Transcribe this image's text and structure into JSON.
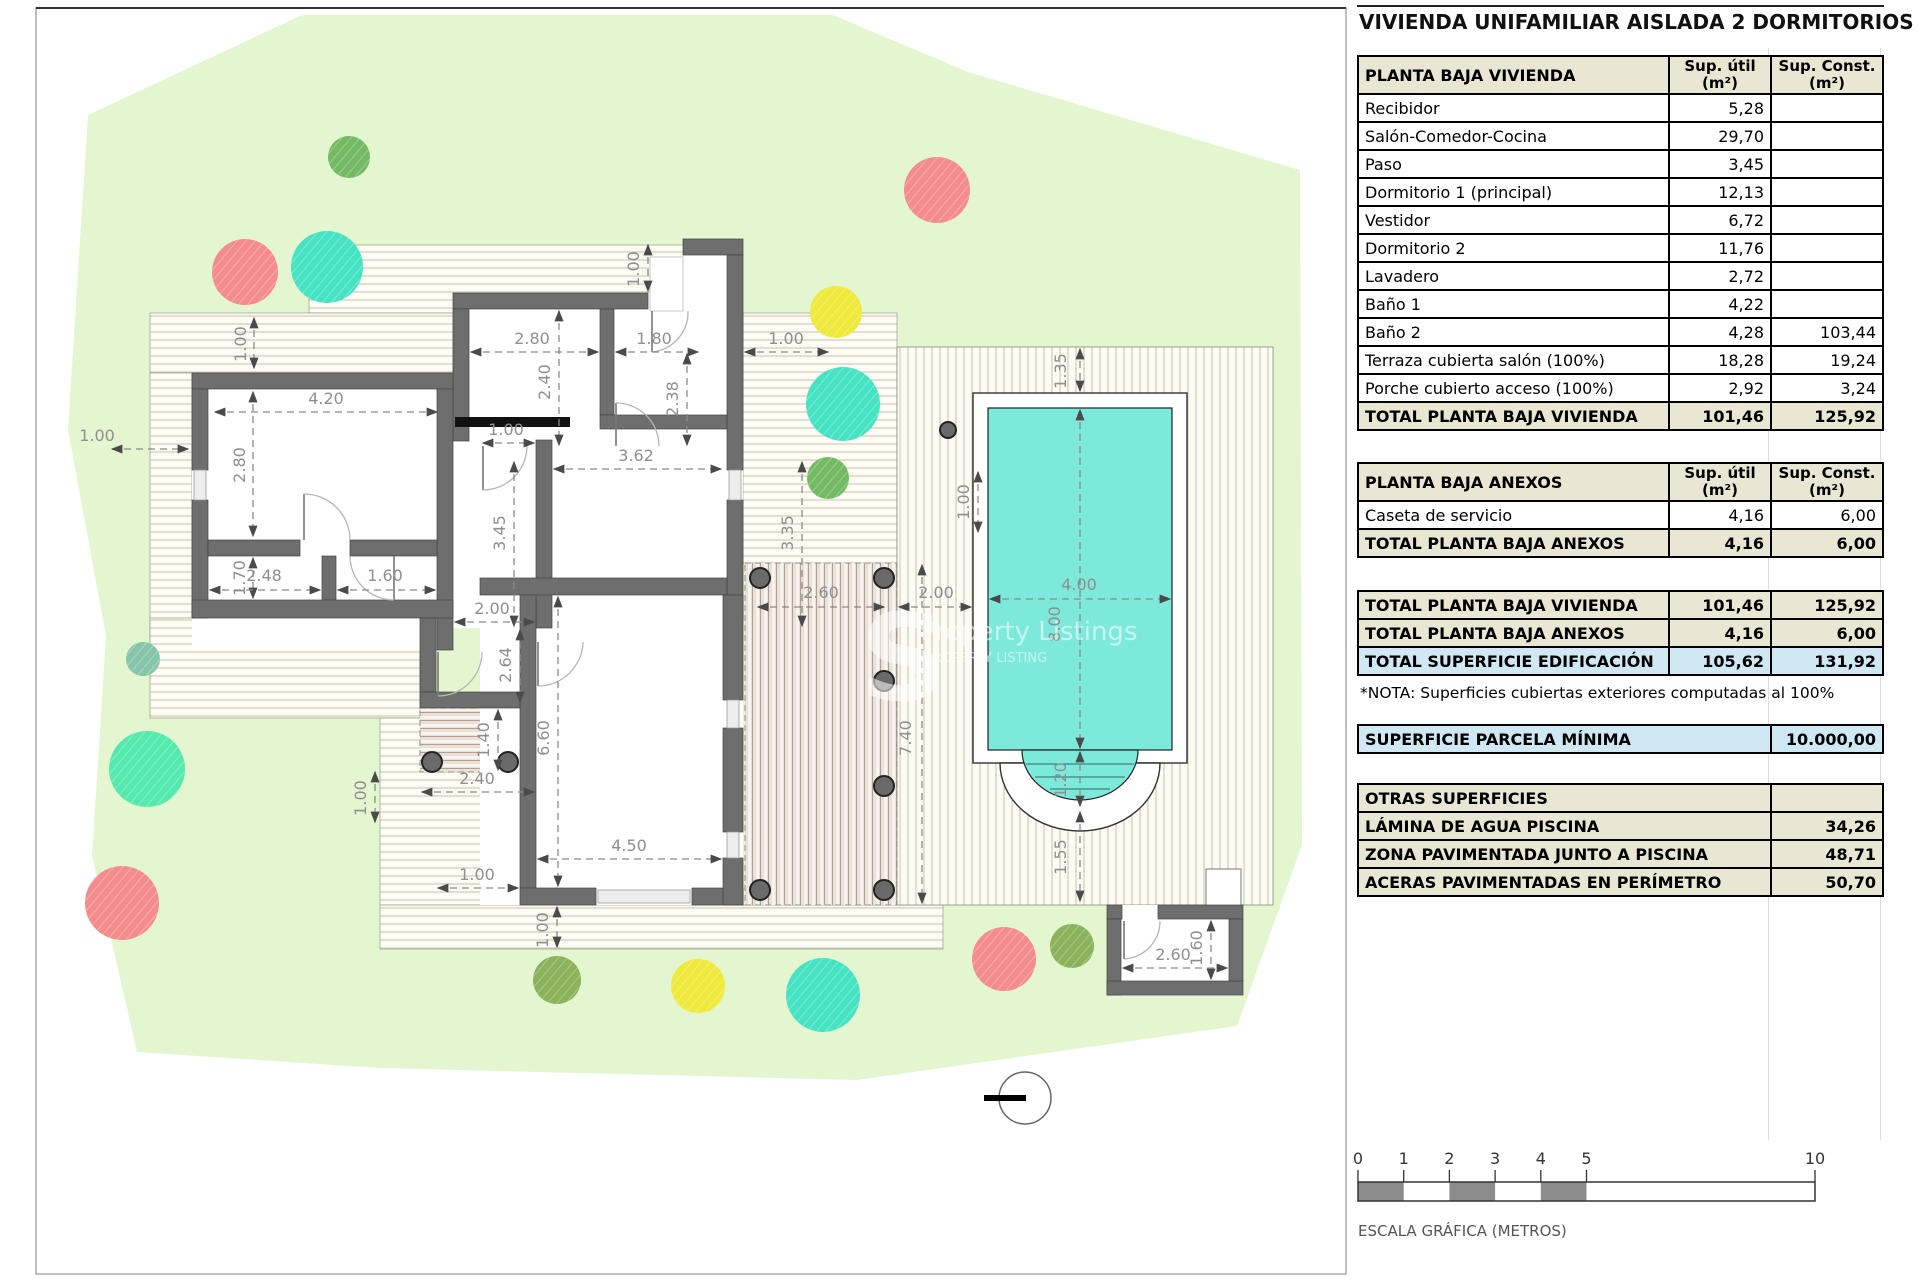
{
  "title": "VIVIENDA UNIFAMILIAR AISLADA 2 DORMITORIOS",
  "panel": {
    "vivienda": {
      "header": {
        "label": "PLANTA BAJA VIVIENDA",
        "col1": [
          "Sup. útil",
          "(m²)"
        ],
        "col2": [
          "Sup. Const.",
          "(m²)"
        ]
      },
      "rows": [
        {
          "label": "Recibidor",
          "util": "5,28",
          "cons": ""
        },
        {
          "label": "Salón-Comedor-Cocina",
          "util": "29,70",
          "cons": ""
        },
        {
          "label": "Paso",
          "util": "3,45",
          "cons": ""
        },
        {
          "label": "Dormitorio 1 (principal)",
          "util": "12,13",
          "cons": ""
        },
        {
          "label": "Vestidor",
          "util": "6,72",
          "cons": ""
        },
        {
          "label": "Dormitorio 2",
          "util": "11,76",
          "cons": ""
        },
        {
          "label": "Lavadero",
          "util": "2,72",
          "cons": ""
        },
        {
          "label": "Baño 1",
          "util": "4,22",
          "cons": ""
        },
        {
          "label": "Baño 2",
          "util": "4,28",
          "cons": "103,44"
        },
        {
          "label": "Terraza cubierta salón (100%)",
          "util": "18,28",
          "cons": "19,24"
        },
        {
          "label": "Porche cubierto acceso (100%)",
          "util": "2,92",
          "cons": "3,24"
        }
      ],
      "total": {
        "label": "TOTAL PLANTA BAJA VIVIENDA",
        "util": "101,46",
        "cons": "125,92"
      }
    },
    "anexos": {
      "header": {
        "label": "PLANTA BAJA ANEXOS",
        "col1": [
          "Sup. útil",
          "(m²)"
        ],
        "col2": [
          "Sup. Const.",
          "(m²)"
        ]
      },
      "rows": [
        {
          "label": "Caseta de servicio",
          "util": "4,16",
          "cons": "6,00"
        }
      ],
      "total": {
        "label": "TOTAL PLANTA BAJA ANEXOS",
        "util": "4,16",
        "cons": "6,00"
      }
    },
    "totales": [
      {
        "label": "TOTAL PLANTA BAJA VIVIENDA",
        "util": "101,46",
        "cons": "125,92",
        "highlight": false
      },
      {
        "label": "TOTAL PLANTA BAJA ANEXOS",
        "util": "4,16",
        "cons": "6,00",
        "highlight": false
      },
      {
        "label": "TOTAL SUPERFICIE EDIFICACIÓN",
        "util": "105,62",
        "cons": "131,92",
        "highlight": true
      }
    ],
    "nota": "*NOTA: Superficies cubiertas exteriores computadas al 100%",
    "parcela": {
      "label": "SUPERFICIE PARCELA MÍNIMA",
      "value": "10.000,00"
    },
    "otras": {
      "header": "OTRAS SUPERFICIES",
      "rows": [
        {
          "label": "LÁMINA DE AGUA PISCINA",
          "value": "34,26"
        },
        {
          "label": "ZONA PAVIMENTADA JUNTO A PISCINA",
          "value": "48,71"
        },
        {
          "label": "ACERAS PAVIMENTADAS EN PERÍMETRO",
          "value": "50,70"
        }
      ]
    }
  },
  "scale_bar": {
    "ticks": [
      {
        "v": 0,
        "t": "0"
      },
      {
        "v": 1,
        "t": "1"
      },
      {
        "v": 2,
        "t": "2"
      },
      {
        "v": 3,
        "t": "3"
      },
      {
        "v": 4,
        "t": "4"
      },
      {
        "v": 5,
        "t": "5"
      },
      {
        "v": 10,
        "t": "10"
      }
    ],
    "filled_segments": [
      [
        0,
        1
      ],
      [
        2,
        3
      ],
      [
        4,
        5
      ]
    ],
    "label": "ESCALA GRÁFICA (METROS)"
  },
  "plan": {
    "watermark": {
      "letter": "S",
      "line1": "Property Listings",
      "line2": "PROPERTY LISTING"
    },
    "dimensions": [
      {
        "t": "1.00",
        "x": 246,
        "y": 344,
        "r": 1,
        "l": [
          254,
          318,
          254,
          368
        ]
      },
      {
        "t": "4.20",
        "x": 326,
        "y": 404,
        "l": [
          215,
          412,
          437,
          412
        ]
      },
      {
        "t": "2.80",
        "x": 245,
        "y": 465,
        "r": 1,
        "l": [
          253,
          392,
          253,
          536
        ]
      },
      {
        "t": "1.00",
        "x": 97,
        "y": 441,
        "l": [
          112,
          449,
          188,
          449
        ]
      },
      {
        "t": "1.70",
        "x": 245,
        "y": 578,
        "r": 1,
        "l": [
          253,
          558,
          253,
          598
        ]
      },
      {
        "t": "2.48",
        "x": 264,
        "y": 581,
        "l": [
          210,
          590,
          320,
          590
        ]
      },
      {
        "t": "1.60",
        "x": 385,
        "y": 581,
        "l": [
          338,
          590,
          435,
          590
        ]
      },
      {
        "t": "2.80",
        "x": 532,
        "y": 344,
        "l": [
          471,
          352,
          598,
          352
        ]
      },
      {
        "t": "1.80",
        "x": 654,
        "y": 344,
        "l": [
          616,
          352,
          698,
          352
        ]
      },
      {
        "t": "1.00",
        "x": 786,
        "y": 344,
        "l": [
          745,
          352,
          828,
          352
        ]
      },
      {
        "t": "2.40",
        "x": 550,
        "y": 382,
        "r": 1,
        "l": [
          559,
          311,
          559,
          445
        ]
      },
      {
        "t": "2.38",
        "x": 678,
        "y": 399,
        "r": 1,
        "l": [
          687,
          354,
          687,
          445
        ]
      },
      {
        "t": "1.00",
        "x": 639,
        "y": 269,
        "r": 1,
        "l": [
          648,
          245,
          648,
          291
        ]
      },
      {
        "t": "1.00",
        "x": 506,
        "y": 435,
        "l": [
          483,
          443,
          534,
          443
        ]
      },
      {
        "t": "3.62",
        "x": 636,
        "y": 461,
        "l": [
          554,
          469,
          721,
          469
        ]
      },
      {
        "t": "3.45",
        "x": 505,
        "y": 533,
        "r": 1,
        "l": [
          514,
          462,
          514,
          626
        ]
      },
      {
        "t": "3.35",
        "x": 793,
        "y": 533,
        "r": 1,
        "l": [
          802,
          462,
          802,
          626
        ]
      },
      {
        "t": "2.00",
        "x": 492,
        "y": 614,
        "l": [
          455,
          622,
          534,
          622
        ]
      },
      {
        "t": "2.64",
        "x": 511,
        "y": 665,
        "r": 1,
        "l": [
          520,
          630,
          520,
          702
        ]
      },
      {
        "t": "1.40",
        "x": 489,
        "y": 740,
        "r": 1,
        "l": [
          498,
          710,
          498,
          770
        ]
      },
      {
        "t": "2.40",
        "x": 477,
        "y": 784,
        "l": [
          422,
          792,
          534,
          792
        ]
      },
      {
        "t": "6.60",
        "x": 549,
        "y": 738,
        "r": 1,
        "l": [
          558,
          597,
          558,
          886
        ]
      },
      {
        "t": "4.50",
        "x": 629,
        "y": 851,
        "l": [
          538,
          859,
          721,
          859
        ]
      },
      {
        "t": "1.00",
        "x": 477,
        "y": 880,
        "l": [
          438,
          888,
          518,
          888
        ]
      },
      {
        "t": "1.00",
        "x": 548,
        "y": 930,
        "r": 1,
        "l": [
          557,
          907,
          557,
          947
        ]
      },
      {
        "t": "1.00",
        "x": 366,
        "y": 798,
        "r": 1,
        "l": [
          375,
          772,
          375,
          822
        ]
      },
      {
        "t": "2.60",
        "x": 821,
        "y": 598,
        "l": [
          758,
          607,
          884,
          607
        ]
      },
      {
        "t": "2.00",
        "x": 936,
        "y": 598,
        "l": [
          899,
          607,
          971,
          607
        ]
      },
      {
        "t": "7.40",
        "x": 911,
        "y": 738,
        "r": 1,
        "l": [
          922,
          565,
          922,
          903
        ]
      },
      {
        "t": "1.00",
        "x": 969,
        "y": 502,
        "r": 1,
        "l": [
          978,
          472,
          978,
          532
        ]
      },
      {
        "t": "4.00",
        "x": 1079,
        "y": 590,
        "l": [
          990,
          599,
          1170,
          599
        ]
      },
      {
        "t": "8.00",
        "x": 1060,
        "y": 624,
        "r": 1,
        "l": [
          1080,
          410,
          1080,
          748
        ]
      },
      {
        "t": "1.35",
        "x": 1066,
        "y": 371,
        "r": 1,
        "l": [
          1080,
          349,
          1080,
          391
        ]
      },
      {
        "t": "1.20",
        "x": 1066,
        "y": 780,
        "r": 1,
        "l": [
          1080,
          752,
          1080,
          806
        ]
      },
      {
        "t": "1.55",
        "x": 1066,
        "y": 857,
        "r": 1,
        "l": [
          1080,
          812,
          1080,
          901
        ]
      },
      {
        "t": "2.60",
        "x": 1173,
        "y": 960,
        "l": [
          1123,
          968,
          1227,
          968
        ]
      },
      {
        "t": "1.60",
        "x": 1202,
        "y": 948,
        "r": 1,
        "l": [
          1211,
          921,
          1211,
          979
        ]
      }
    ],
    "trees": [
      {
        "x": 349,
        "y": 157,
        "r": 21,
        "c": "tree_green"
      },
      {
        "x": 937,
        "y": 190,
        "r": 33,
        "c": "tree_red"
      },
      {
        "x": 245,
        "y": 272,
        "r": 33,
        "c": "tree_red"
      },
      {
        "x": 327,
        "y": 267,
        "r": 36,
        "c": "tree_teal"
      },
      {
        "x": 836,
        "y": 312,
        "r": 26,
        "c": "tree_yellow"
      },
      {
        "x": 843,
        "y": 404,
        "r": 37,
        "c": "tree_teal"
      },
      {
        "x": 828,
        "y": 478,
        "r": 21,
        "c": "tree_green"
      },
      {
        "x": 143,
        "y": 659,
        "r": 17,
        "c": "tree_sage"
      },
      {
        "x": 147,
        "y": 769,
        "r": 38,
        "c": "tree_mint"
      },
      {
        "x": 122,
        "y": 903,
        "r": 37,
        "c": "tree_red"
      },
      {
        "x": 557,
        "y": 980,
        "r": 24,
        "c": "tree_olive"
      },
      {
        "x": 698,
        "y": 986,
        "r": 27,
        "c": "tree_yellow"
      },
      {
        "x": 823,
        "y": 995,
        "r": 37,
        "c": "tree_teal"
      },
      {
        "x": 1004,
        "y": 959,
        "r": 32,
        "c": "tree_red"
      },
      {
        "x": 1072,
        "y": 946,
        "r": 22,
        "c": "tree_olive"
      }
    ],
    "columns": [
      [
        760,
        578,
        10
      ],
      [
        884,
        578,
        10
      ],
      [
        884,
        681,
        10
      ],
      [
        884,
        786,
        10
      ],
      [
        760,
        890,
        10
      ],
      [
        884,
        890,
        10
      ],
      [
        432,
        762,
        10
      ],
      [
        508,
        762,
        10
      ],
      [
        948,
        430,
        8
      ]
    ]
  },
  "colors": {
    "plot_green": "#e3f6d0",
    "wall": "#6e6e6e",
    "pool_water": "#7de9da",
    "hatch_bg": "#fcfbf4",
    "hatch_line": "#c9c3ae",
    "deck_bg": "#e9e0d8",
    "deck_line": "#b29f92",
    "header_beige": "#e9e6d3",
    "highlight_blue": "#cfe8f3",
    "dim_text": "#8f8f8f",
    "scale_fill": "#8c8c8c",
    "tree_red": "#f58c8c",
    "tree_teal": "#46e3c3",
    "tree_yellow": "#efe93c",
    "tree_green": "#74ba64",
    "tree_olive": "#8ab35c",
    "tree_mint": "#55e9ad",
    "tree_sage": "#86c5a9"
  }
}
